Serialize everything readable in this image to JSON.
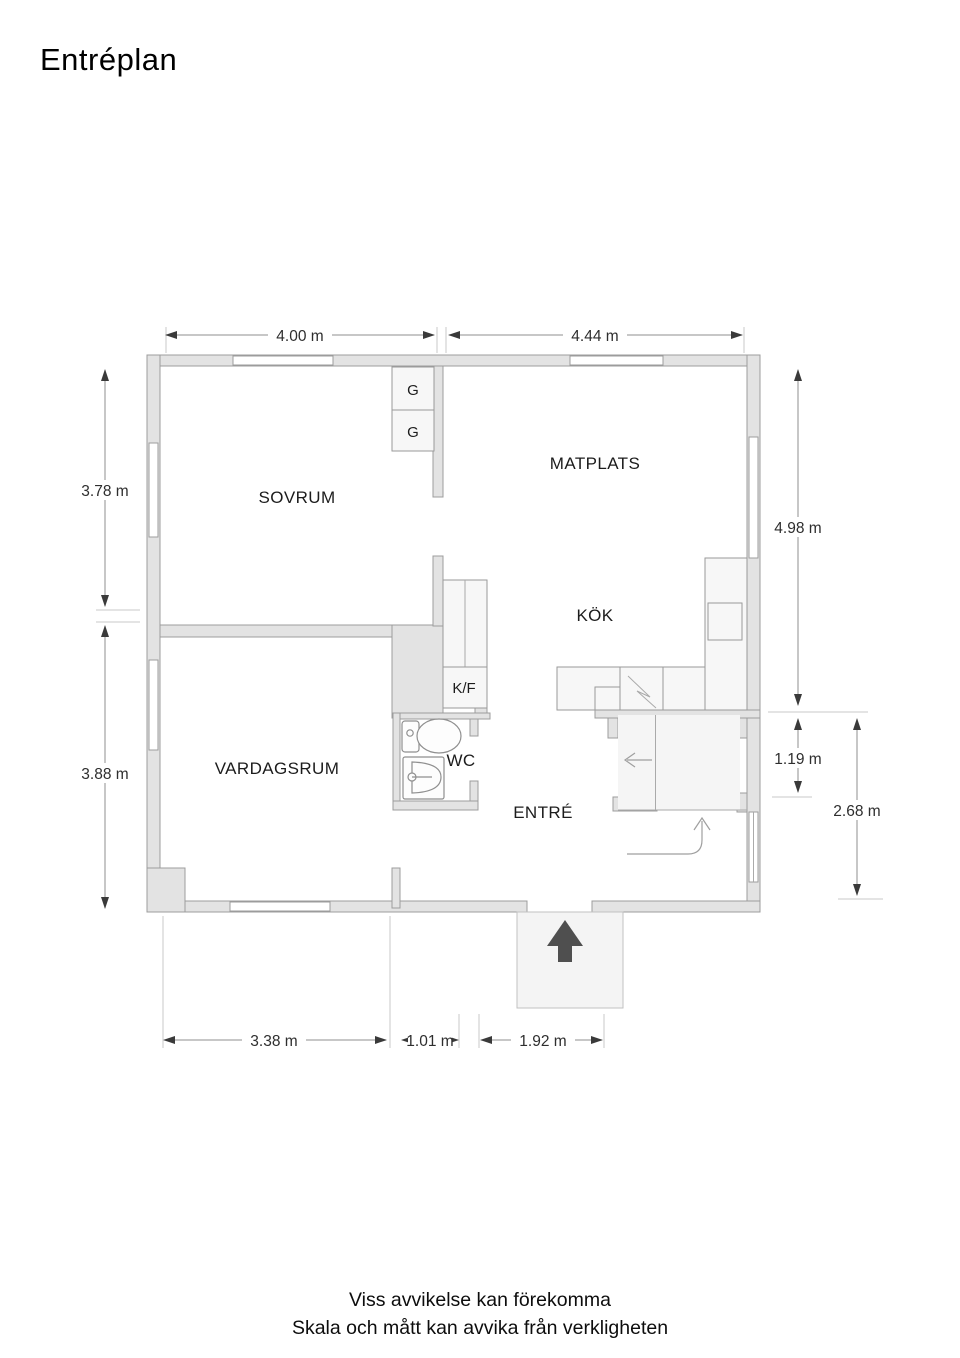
{
  "title": "Entréplan",
  "rooms": [
    {
      "label": "SOVRUM"
    },
    {
      "label": "MATPLATS"
    },
    {
      "label": "KÖK"
    },
    {
      "label": "VARDAGSRUM"
    },
    {
      "label": "WC"
    },
    {
      "label": "ENTRÉ"
    }
  ],
  "fixtures": {
    "wardrobe_1": "G",
    "wardrobe_2": "G",
    "fridge_freezer": "K/F"
  },
  "dimensions": {
    "top": [
      {
        "label": "4.00 m"
      },
      {
        "label": "4.44 m"
      }
    ],
    "left": [
      {
        "label": "3.78 m"
      },
      {
        "label": "3.88 m"
      }
    ],
    "right": [
      {
        "label": "4.98 m"
      },
      {
        "label": "1.19 m"
      },
      {
        "label": "2.68 m"
      }
    ],
    "bottom": [
      {
        "label": "3.38 m"
      },
      {
        "label": "1.01 m"
      },
      {
        "label": "1.92 m"
      }
    ]
  },
  "footer": {
    "line1": "Viss avvikelse kan förekomma",
    "line2": "Skala och mått kan avvika från verkligheten"
  },
  "colors": {
    "wall": "#e3e3e3",
    "wall_border": "#9c9c9c",
    "fixture_fill": "#f7f7f7",
    "dim_line": "#8f8f8f",
    "arrow_dark": "#4f4f4f",
    "text": "#1c1c1c"
  }
}
